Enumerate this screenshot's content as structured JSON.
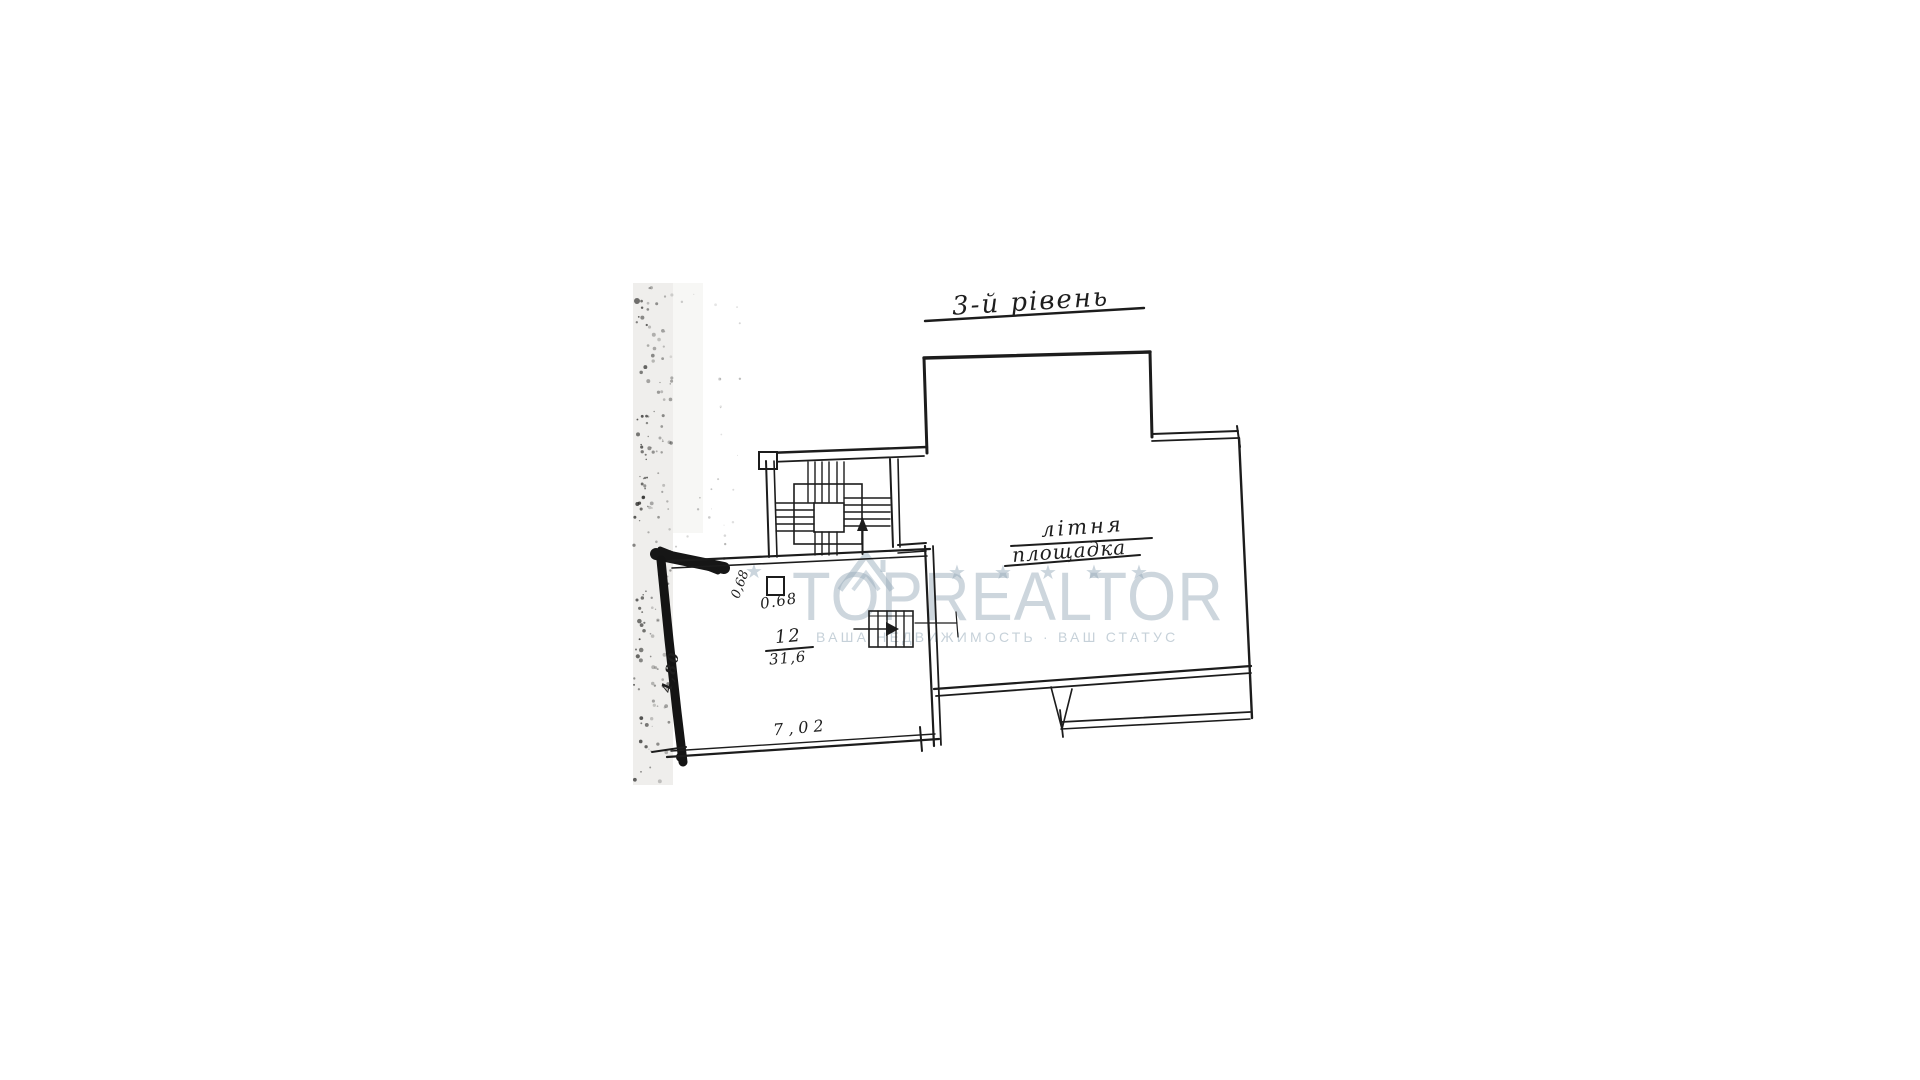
{
  "page": {
    "background": "#ffffff",
    "ink": "#1c1c1c"
  },
  "plan": {
    "title": "3-й рівень",
    "terrace_label": {
      "line1": "літня",
      "line2": "площадка"
    },
    "room12": {
      "number": "12",
      "area": "31,6",
      "bottom_dimension": "7,02",
      "left_dimension": "4,80",
      "shaft_dimension_vertical": "0,68",
      "shaft_dimension_horizontal": "0.68"
    }
  },
  "watermark": {
    "brand": "TOPREALTOR",
    "slogan": "ВАША НЕДВИЖИМОСТЬ · ВАШ СТАТУС",
    "star": "★",
    "color": "#9bb0bf"
  }
}
